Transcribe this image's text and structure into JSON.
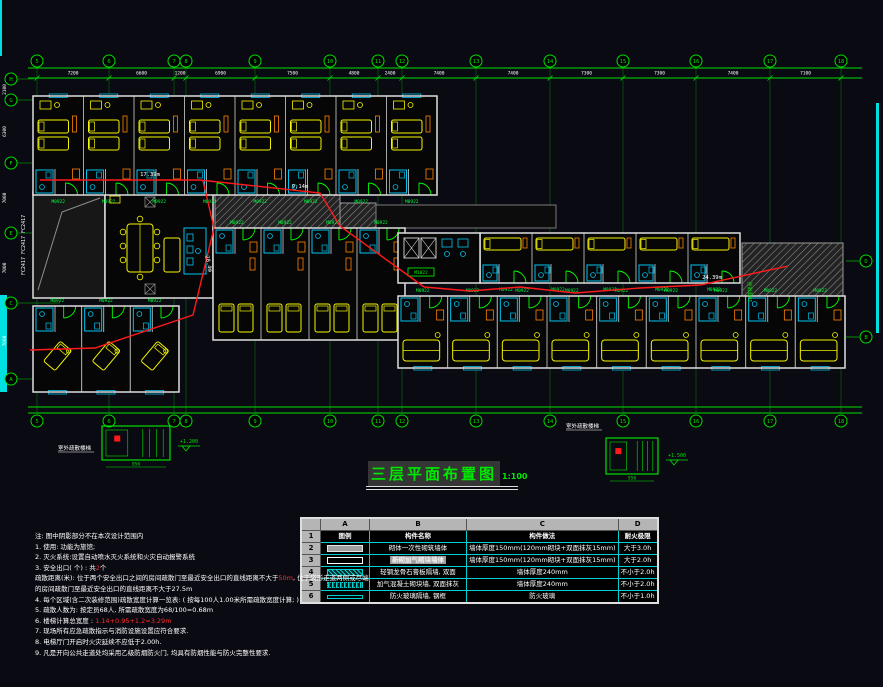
{
  "colors": {
    "grid": "#00e000",
    "wall": "#a8a8a8",
    "wall_bright": "#dedede",
    "bed": "#f5f500",
    "bath": "#00c4f0",
    "orange": "#ff8400",
    "door": "#00ff00",
    "route": "#ff1a1a",
    "white": "#ffffff",
    "hatch_line": "#8c8c8c",
    "edge_cyan": "#00e0e0",
    "label_green": "#00ff3c",
    "title_green": "#00e800",
    "red_text": "#ff2a2a"
  },
  "title": {
    "text": "三层平面布置图",
    "scale": "1:100"
  },
  "grid": {
    "top": {
      "y1": 68,
      "y2": 78,
      "x1": 28,
      "x2": 862,
      "bubble_y": 61,
      "bubbles": [
        [
          "5",
          37
        ],
        [
          "6",
          109
        ],
        [
          "7",
          174
        ],
        [
          "8",
          186
        ],
        [
          "9",
          255
        ],
        [
          "10",
          330
        ],
        [
          "11",
          378
        ],
        [
          "12",
          402
        ],
        [
          "13",
          476
        ],
        [
          "14",
          550
        ],
        [
          "15",
          623
        ],
        [
          "16",
          696
        ],
        [
          "17",
          770
        ],
        [
          "18",
          841
        ]
      ],
      "dims": [
        "7200",
        "6600",
        "1200",
        "6900",
        "7500",
        "4800",
        "2400",
        "7400",
        "7400",
        "7300",
        "7300",
        "7400",
        "7100"
      ]
    },
    "bottom": {
      "y1": 407,
      "y2": 413,
      "bubble_y": 421
    },
    "left": {
      "x": 11,
      "bubbles": [
        [
          "H",
          79,
          34
        ],
        [
          "G",
          100,
          110
        ],
        [
          "F",
          163,
          48
        ],
        [
          "E",
          233,
          212
        ],
        [
          "C",
          303,
          60
        ],
        [
          "A",
          379,
          180
        ]
      ],
      "dims": [
        "2100",
        "6300",
        "7000",
        "7000",
        "7600"
      ]
    },
    "right": {
      "x": 866,
      "bubbles": [
        [
          "D",
          261
        ],
        [
          "B",
          337
        ]
      ]
    }
  },
  "plan": {
    "door_label": "M0922",
    "lobby_label": "M1022",
    "window_label": "FC2417  FC2417  FC2417",
    "stair_label": "1#楼梯间",
    "edge_strips": [
      {
        "x": 0,
        "y": 0,
        "w": 2,
        "h": 56
      },
      {
        "x": 0,
        "y": 295,
        "w": 7,
        "h": 97
      },
      {
        "x": 876,
        "y": 103,
        "w": 3,
        "h": 230
      }
    ],
    "hatches": [
      {
        "x": 215,
        "y": 192,
        "w": 125,
        "h": 36
      },
      {
        "x": 340,
        "y": 203,
        "w": 36,
        "h": 25
      },
      {
        "x": 742,
        "y": 243,
        "w": 101,
        "h": 89
      }
    ],
    "roof_band": {
      "x": 376,
      "y": 205,
      "w": 180,
      "h": 23
    },
    "void_room": {
      "x": 33,
      "y": 192,
      "w": 72,
      "h": 106
    },
    "lounge": {
      "x": 105,
      "y": 192,
      "w": 108,
      "h": 106
    },
    "lobby": {
      "x": 398,
      "y": 233,
      "w": 82,
      "h": 50
    },
    "blocks": [
      {
        "name": "top-wing",
        "x": 33,
        "y": 96,
        "w": 404,
        "h": 99,
        "rooms": 8,
        "door": "bottom",
        "beds": "stacked",
        "win": "top"
      },
      {
        "name": "mid-block",
        "x": 213,
        "y": 228,
        "w": 192,
        "h": 112,
        "rooms": 4,
        "door": "top",
        "beds": "pair",
        "win": "none"
      },
      {
        "name": "right-top",
        "x": 480,
        "y": 233,
        "w": 260,
        "h": 50,
        "rooms": 5,
        "door": "bottom",
        "beds": "single",
        "win": "none"
      },
      {
        "name": "right-bottom",
        "x": 398,
        "y": 296,
        "w": 447,
        "h": 72,
        "rooms": 9,
        "door": "top",
        "beds": "wide",
        "win": "bottom"
      },
      {
        "name": "bottom-left",
        "x": 33,
        "y": 306,
        "w": 146,
        "h": 86,
        "rooms": 3,
        "door": "top",
        "beds": "diag",
        "win": "bottom"
      }
    ],
    "routes": [
      [
        [
          40,
          180
        ],
        [
          200,
          180
        ],
        [
          320,
          193
        ],
        [
          340,
          226
        ],
        [
          424,
          287
        ]
      ],
      [
        [
          203,
          181
        ],
        [
          214,
          228
        ],
        [
          193,
          315
        ],
        [
          95,
          348
        ],
        [
          30,
          350
        ]
      ],
      [
        [
          424,
          287
        ],
        [
          470,
          291
        ],
        [
          520,
          287
        ],
        [
          575,
          293
        ],
        [
          640,
          288
        ],
        [
          700,
          285
        ],
        [
          788,
          266
        ]
      ]
    ],
    "route_labels": [
      {
        "t": "17.39m",
        "x": 150,
        "y": 176,
        "r": 0
      },
      {
        "t": "9.14m",
        "x": 300,
        "y": 188,
        "r": 0
      },
      {
        "t": "24.39m",
        "x": 712,
        "y": 279,
        "r": 0
      },
      {
        "t": "28.4m",
        "x": 207,
        "y": 264,
        "r": 78
      }
    ],
    "details": [
      {
        "x": 102,
        "y": 426,
        "w": 68,
        "h": 34,
        "label": "室外疏散楼梯",
        "labelx": 58,
        "labely": 450,
        "level": "+1.200",
        "dim": "950"
      },
      {
        "x": 606,
        "y": 438,
        "w": 52,
        "h": 36,
        "label": "室外疏散楼梯",
        "labelx": 566,
        "labely": 428,
        "level": "+1.500",
        "dim": "950"
      }
    ]
  },
  "legend_table": {
    "col_letters": [
      "A",
      "B",
      "C",
      "D"
    ],
    "header_row": {
      "num": "1",
      "cells": [
        "图例",
        "构件名称",
        "构件做法",
        "耐火极限"
      ]
    },
    "rows": [
      {
        "num": "2",
        "legend": "solid",
        "name": "砌体一次性砌筑墙体",
        "method": "墙体厚度150mm(120mm砌块+双面抹灰15mm)",
        "fire": "大于3.0h",
        "highlight": false
      },
      {
        "num": "3",
        "legend": "hollow",
        "name": "新砌加气砌块墙体",
        "method": "墙体厚度150mm(120mm砌块+双面抹灰15mm)",
        "fire": "大于2.0h",
        "highlight": true
      },
      {
        "num": "4",
        "legend": "hatch",
        "name": "轻钢龙骨石膏板隔墙, 双面",
        "method": "墙体厚度240mm",
        "fire": "不小于2.0h",
        "highlight": false
      },
      {
        "num": "5",
        "legend": "dots",
        "name": "加气混凝土砌块墙, 双面抹灰",
        "method": "墙体厚度240mm",
        "fire": "不小于2.0h",
        "highlight": false
      },
      {
        "num": "6",
        "legend": "thin",
        "name": "防火玻璃隔墙, 钢框",
        "method": "防火玻璃",
        "fire": "不小于1.0h",
        "highlight": false
      }
    ]
  },
  "notes": {
    "lines": [
      [
        {
          "t": "注: 图中阴影部分不在本次设计范围内"
        }
      ],
      [
        {
          "t": "1. 使用: 功能为旅馆;"
        }
      ],
      [
        {
          "t": "2. 灭火系统:设置自动喷水灭火系统和火灾自动报警系统"
        }
      ],
      [
        {
          "t": "3. 安全出口( 个) : 共"
        },
        {
          "t": "2",
          "red": true
        },
        {
          "t": "个"
        }
      ],
      [
        {
          "t": "疏散距离(米): 位于两个安全出口之间的房间疏散门至最近安全出口的直线距离不大于"
        },
        {
          "t": "50m",
          "red": true
        },
        {
          "t": ", 位于袋形走道两侧或尽端"
        }
      ],
      [
        {
          "t": "的房间疏散门至最近安全出口的直线距离不大于27.5m"
        }
      ],
      [
        {
          "t": "4. 每个区域(含二次装修范围)疏散宽度计算一览表: ( 按每100人1.00米所需疏散宽度计算; )"
        }
      ],
      [
        {
          "t": "5. 疏散人数为: 按定员68人, 所需疏散宽度为68/100=0.68m"
        }
      ],
      [
        {
          "t": "6. 楼梯计算总宽度 : "
        },
        {
          "t": "1.14+0.95+1.2=3.29m",
          "red": true
        }
      ],
      [
        {
          "t": "7. 现场所有应急疏散指示与消防设施设置应符合要求."
        }
      ],
      [
        {
          "t": "8. 电梯厅门开启时火灾延续不应低于2.00h."
        }
      ],
      [
        {
          "t": "9. 凡是开向公共走道处均采用乙级防烟防火门, 均具有防烟性能与防火完整性要求."
        }
      ]
    ]
  }
}
